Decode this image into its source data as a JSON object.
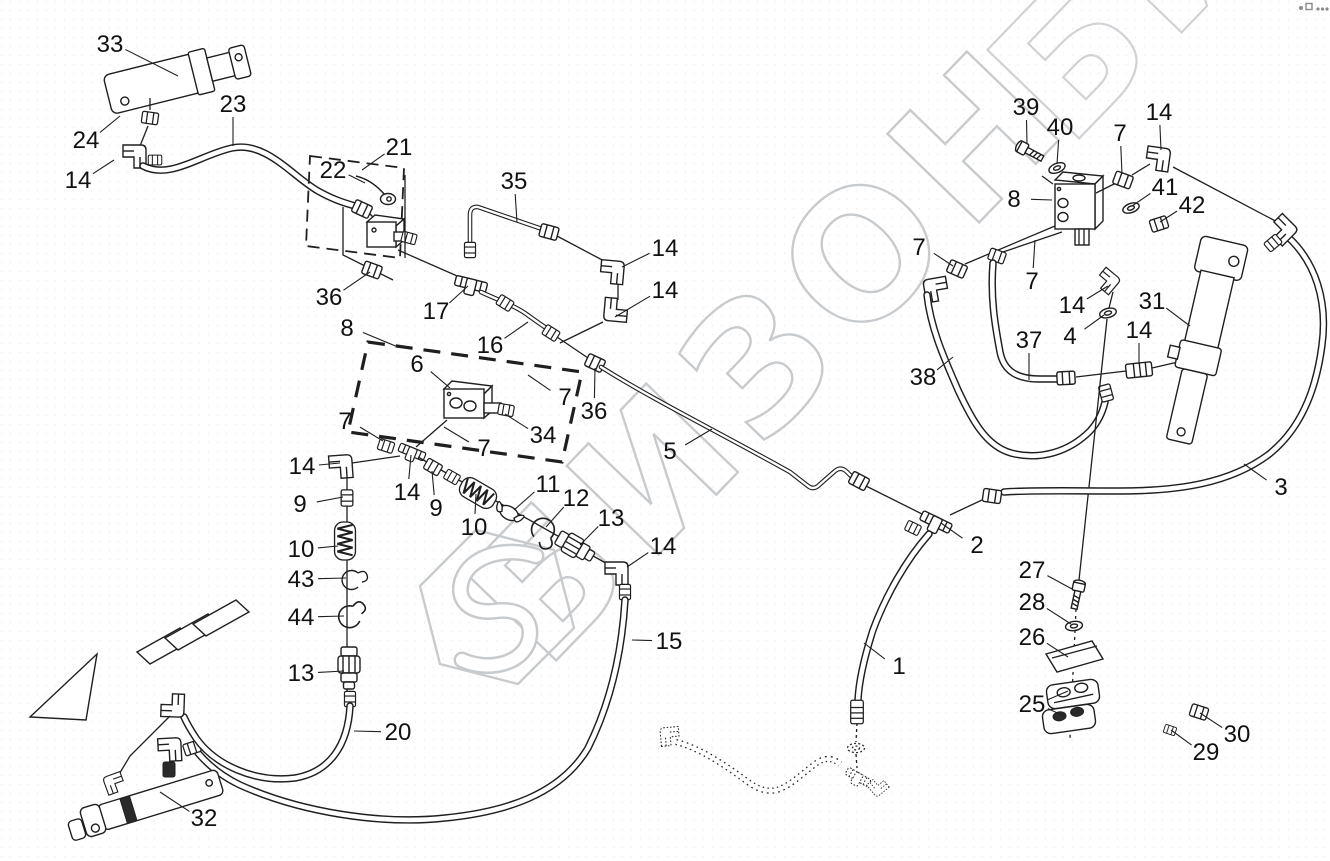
{
  "watermark": {
    "text": "БИЗОН",
    "color": "#c8cbce",
    "logo": "bizon-hexagon-logo"
  },
  "callouts": [
    {
      "n": "33",
      "x": 110,
      "y": 44,
      "t": [
        [
          178,
          76
        ]
      ]
    },
    {
      "n": "24",
      "x": 86,
      "y": 140,
      "t": [
        [
          120,
          116
        ]
      ]
    },
    {
      "n": "14",
      "x": 78,
      "y": 180,
      "t": [
        [
          114,
          160
        ]
      ]
    },
    {
      "n": "23",
      "x": 233,
      "y": 104,
      "t": [
        [
          233,
          146
        ]
      ]
    },
    {
      "n": "21",
      "x": 399,
      "y": 147,
      "t": [
        [
          362,
          170
        ]
      ]
    },
    {
      "n": "22",
      "x": 333,
      "y": 170,
      "t": [
        [
          365,
          183
        ]
      ]
    },
    {
      "n": "35",
      "x": 514,
      "y": 181,
      "t": [
        [
          517,
          222
        ]
      ]
    },
    {
      "n": "14",
      "x": 665,
      "y": 248,
      "t": [
        [
          622,
          267
        ]
      ]
    },
    {
      "n": "14",
      "x": 665,
      "y": 290,
      "t": [
        [
          615,
          317
        ]
      ]
    },
    {
      "n": "36",
      "x": 329,
      "y": 297,
      "t": [
        [
          370,
          272
        ]
      ]
    },
    {
      "n": "17",
      "x": 436,
      "y": 311,
      "t": [
        [
          468,
          286
        ]
      ]
    },
    {
      "n": "16",
      "x": 490,
      "y": 345,
      "t": [
        [
          528,
          322
        ]
      ]
    },
    {
      "n": "8",
      "x": 347,
      "y": 328,
      "t": [
        [
          398,
          347
        ]
      ]
    },
    {
      "n": "6",
      "x": 417,
      "y": 364,
      "t": [
        [
          450,
          388
        ]
      ]
    },
    {
      "n": "7",
      "x": 565,
      "y": 397,
      "t": [
        [
          528,
          375
        ]
      ]
    },
    {
      "n": "36",
      "x": 594,
      "y": 411,
      "t": [
        [
          595,
          368
        ]
      ]
    },
    {
      "n": "34",
      "x": 543,
      "y": 435,
      "t": [
        [
          505,
          414
        ]
      ]
    },
    {
      "n": "7",
      "x": 484,
      "y": 448,
      "t": [
        [
          444,
          427
        ]
      ]
    },
    {
      "n": "7",
      "x": 345,
      "y": 421,
      "t": [
        [
          383,
          441
        ]
      ]
    },
    {
      "n": "14",
      "x": 302,
      "y": 466,
      "t": [
        [
          340,
          463
        ]
      ]
    },
    {
      "n": "9",
      "x": 300,
      "y": 504,
      "t": [
        [
          343,
          497
        ]
      ]
    },
    {
      "n": "10",
      "x": 301,
      "y": 549,
      "t": [
        [
          338,
          546
        ]
      ]
    },
    {
      "n": "43",
      "x": 301,
      "y": 579,
      "t": [
        [
          346,
          578
        ]
      ]
    },
    {
      "n": "44",
      "x": 301,
      "y": 617,
      "t": [
        [
          344,
          616
        ]
      ]
    },
    {
      "n": "13",
      "x": 301,
      "y": 673,
      "t": [
        [
          344,
          671
        ]
      ]
    },
    {
      "n": "14",
      "x": 407,
      "y": 492,
      "t": [
        [
          411,
          455
        ]
      ]
    },
    {
      "n": "9",
      "x": 436,
      "y": 508,
      "t": [
        [
          432,
          471
        ]
      ]
    },
    {
      "n": "10",
      "x": 474,
      "y": 527,
      "t": [
        [
          476,
          494
        ]
      ]
    },
    {
      "n": "11",
      "x": 548,
      "y": 484,
      "t": [
        [
          514,
          510
        ]
      ]
    },
    {
      "n": "12",
      "x": 576,
      "y": 498,
      "t": [
        [
          546,
          527
        ]
      ]
    },
    {
      "n": "13",
      "x": 611,
      "y": 518,
      "t": [
        [
          580,
          545
        ]
      ]
    },
    {
      "n": "14",
      "x": 663,
      "y": 546,
      "t": [
        [
          627,
          567
        ]
      ]
    },
    {
      "n": "15",
      "x": 669,
      "y": 641,
      "t": [
        [
          632,
          640
        ]
      ]
    },
    {
      "n": "20",
      "x": 398,
      "y": 732,
      "t": [
        [
          354,
          731
        ]
      ]
    },
    {
      "n": "32",
      "x": 204,
      "y": 818,
      "t": [
        [
          160,
          792
        ]
      ]
    },
    {
      "n": "5",
      "x": 670,
      "y": 451,
      "t": [
        [
          712,
          429
        ]
      ]
    },
    {
      "n": "2",
      "x": 977,
      "y": 545,
      "t": [
        [
          941,
          523
        ]
      ]
    },
    {
      "n": "1",
      "x": 899,
      "y": 666,
      "t": [
        [
          864,
          643
        ]
      ]
    },
    {
      "n": "3",
      "x": 1281,
      "y": 487,
      "t": [
        [
          1244,
          464
        ]
      ]
    },
    {
      "n": "38",
      "x": 923,
      "y": 377,
      "t": [
        [
          953,
          357
        ]
      ]
    },
    {
      "n": "37",
      "x": 1029,
      "y": 340,
      "t": [
        [
          1029,
          380
        ]
      ]
    },
    {
      "n": "4",
      "x": 1070,
      "y": 336,
      "t": [
        [
          1104,
          315
        ]
      ]
    },
    {
      "n": "14",
      "x": 1072,
      "y": 305,
      "t": [
        [
          1108,
          286
        ]
      ]
    },
    {
      "n": "31",
      "x": 1152,
      "y": 301,
      "t": [
        [
          1190,
          326
        ]
      ]
    },
    {
      "n": "14",
      "x": 1139,
      "y": 330,
      "t": [
        [
          1139,
          364
        ]
      ]
    },
    {
      "n": "39",
      "x": 1026,
      "y": 107,
      "t": [
        [
          1027,
          144
        ]
      ]
    },
    {
      "n": "40",
      "x": 1060,
      "y": 127,
      "t": [
        [
          1057,
          164
        ]
      ]
    },
    {
      "n": "7",
      "x": 1120,
      "y": 133,
      "t": [
        [
          1122,
          174
        ]
      ]
    },
    {
      "n": "14",
      "x": 1159,
      "y": 112,
      "t": [
        [
          1161,
          150
        ]
      ]
    },
    {
      "n": "8",
      "x": 1014,
      "y": 199,
      "t": [
        [
          1052,
          200
        ]
      ]
    },
    {
      "n": "41",
      "x": 1165,
      "y": 187,
      "t": [
        [
          1132,
          206
        ]
      ]
    },
    {
      "n": "42",
      "x": 1192,
      "y": 205,
      "t": [
        [
          1160,
          222
        ]
      ]
    },
    {
      "n": "7",
      "x": 919,
      "y": 247,
      "t": [
        [
          953,
          266
        ]
      ]
    },
    {
      "n": "7",
      "x": 1032,
      "y": 281,
      "t": [
        [
          1035,
          240
        ]
      ]
    },
    {
      "n": "27",
      "x": 1032,
      "y": 570,
      "t": [
        [
          1072,
          589
        ]
      ]
    },
    {
      "n": "28",
      "x": 1032,
      "y": 602,
      "t": [
        [
          1071,
          624
        ]
      ]
    },
    {
      "n": "26",
      "x": 1032,
      "y": 637,
      "t": [
        [
          1068,
          657
        ]
      ]
    },
    {
      "n": "25",
      "x": 1032,
      "y": 704,
      "t": [
        [
          1068,
          691
        ],
        [
          1064,
          716
        ]
      ]
    },
    {
      "n": "30",
      "x": 1237,
      "y": 734,
      "t": [
        [
          1200,
          713
        ]
      ]
    },
    {
      "n": "29",
      "x": 1206,
      "y": 752,
      "t": [
        [
          1171,
          730
        ]
      ]
    }
  ]
}
